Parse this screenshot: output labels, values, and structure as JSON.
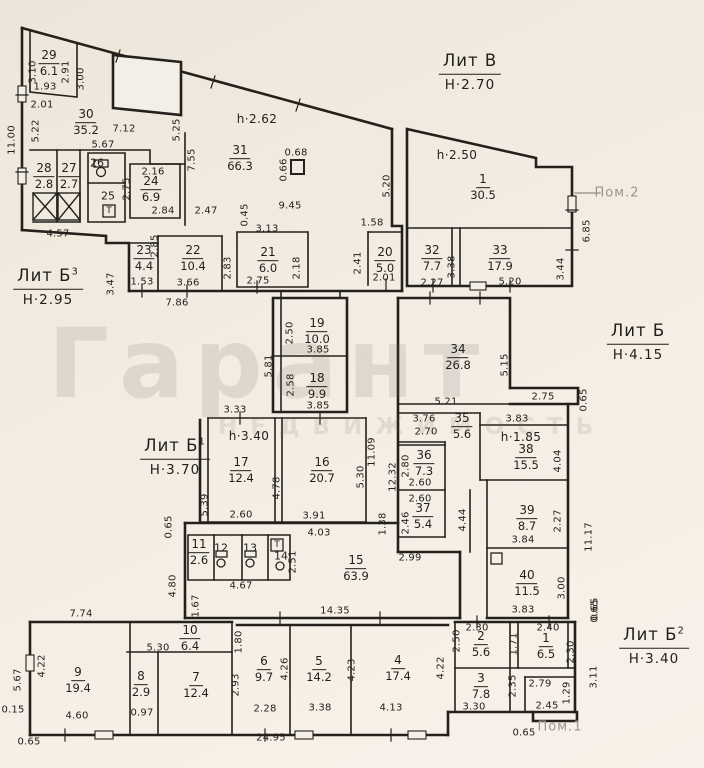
{
  "watermark": {
    "line1": "Гарант",
    "line2": "НЕДВИЖИМОСТЬ"
  },
  "colors": {
    "ink": "#211f1b",
    "paper": "#f2ede3",
    "watermark_grey": "#9a948a"
  },
  "buildings": [
    {
      "label": "Лит В",
      "sup": "",
      "height": "Н·2.70",
      "x": 470,
      "y": 72
    },
    {
      "label": "Лит Б",
      "sup": "3",
      "height": "Н·2.95",
      "x": 48,
      "y": 287
    },
    {
      "label": "Лит Б",
      "sup": "",
      "height": "Н·4.15",
      "x": 638,
      "y": 342
    },
    {
      "label": "Лит Б",
      "sup": "1",
      "height": "Н·3.70",
      "x": 175,
      "y": 457
    },
    {
      "label": "Лит Б",
      "sup": "2",
      "height": "Н·3.40",
      "x": 654,
      "y": 646
    }
  ],
  "rooms": [
    {
      "n": "29",
      "a": "6.1",
      "x": 49,
      "y": 63
    },
    {
      "n": "30",
      "a": "35.2",
      "x": 86,
      "y": 122
    },
    {
      "n": "31",
      "a": "66.3",
      "x": 240,
      "y": 158
    },
    {
      "n": "1",
      "a": "30.5",
      "x": 483,
      "y": 187
    },
    {
      "n": "28",
      "a": "2.8",
      "x": 44,
      "y": 176
    },
    {
      "n": "27",
      "a": "2.7",
      "x": 69,
      "y": 176
    },
    {
      "n": "26",
      "a": null,
      "x": 97,
      "y": 163
    },
    {
      "n": "25",
      "a": null,
      "x": 108,
      "y": 196
    },
    {
      "n": "24",
      "a": "6.9",
      "x": 151,
      "y": 189
    },
    {
      "n": "23",
      "a": "4.4",
      "x": 144,
      "y": 258
    },
    {
      "n": "22",
      "a": "10.4",
      "x": 193,
      "y": 258
    },
    {
      "n": "21",
      "a": "6.0",
      "x": 268,
      "y": 260
    },
    {
      "n": "20",
      "a": "5.0",
      "x": 385,
      "y": 260
    },
    {
      "n": "32",
      "a": "7.7",
      "x": 432,
      "y": 258
    },
    {
      "n": "33",
      "a": "17.9",
      "x": 500,
      "y": 258
    },
    {
      "n": "19",
      "a": "10.0",
      "x": 317,
      "y": 331
    },
    {
      "n": "18",
      "a": "9.9",
      "x": 317,
      "y": 386
    },
    {
      "n": "34",
      "a": "26.8",
      "x": 458,
      "y": 357
    },
    {
      "n": "17",
      "a": "12.4",
      "x": 241,
      "y": 470
    },
    {
      "n": "16",
      "a": "20.7",
      "x": 322,
      "y": 470
    },
    {
      "n": "35",
      "a": "5.6",
      "x": 462,
      "y": 426
    },
    {
      "n": "36",
      "a": "7.3",
      "x": 424,
      "y": 463
    },
    {
      "n": "37",
      "a": "5.4",
      "x": 423,
      "y": 516
    },
    {
      "n": "38",
      "a": "15.5",
      "x": 526,
      "y": 457
    },
    {
      "n": "39",
      "a": "8.7",
      "x": 527,
      "y": 518
    },
    {
      "n": "40",
      "a": "11.5",
      "x": 527,
      "y": 583
    },
    {
      "n": "15",
      "a": "63.9",
      "x": 356,
      "y": 568
    },
    {
      "n": "11",
      "a": "2.6",
      "x": 199,
      "y": 552
    },
    {
      "n": "12",
      "a": null,
      "x": 221,
      "y": 548
    },
    {
      "n": "13",
      "a": null,
      "x": 250,
      "y": 548
    },
    {
      "n": "14",
      "a": null,
      "x": 281,
      "y": 556
    },
    {
      "n": "10",
      "a": "6.4",
      "x": 190,
      "y": 638
    },
    {
      "n": "9",
      "a": "19.4",
      "x": 78,
      "y": 680
    },
    {
      "n": "8",
      "a": "2.9",
      "x": 141,
      "y": 684
    },
    {
      "n": "7",
      "a": "12.4",
      "x": 196,
      "y": 685
    },
    {
      "n": "6",
      "a": "9.7",
      "x": 264,
      "y": 669
    },
    {
      "n": "5",
      "a": "14.2",
      "x": 319,
      "y": 669
    },
    {
      "n": "4",
      "a": "17.4",
      "x": 398,
      "y": 668
    },
    {
      "n": "3",
      "a": "7.8",
      "x": 481,
      "y": 686
    },
    {
      "n": "2",
      "a": "5.6",
      "x": 481,
      "y": 644
    },
    {
      "n": "1",
      "a": "6.5",
      "x": 546,
      "y": 646
    }
  ],
  "heights": [
    {
      "t": "h·2.62",
      "x": 257,
      "y": 119
    },
    {
      "t": "h·2.50",
      "x": 457,
      "y": 155
    },
    {
      "t": "h·3.40",
      "x": 249,
      "y": 436
    },
    {
      "t": "h·1.85",
      "x": 521,
      "y": 437
    }
  ],
  "notes": [
    {
      "t": "Пом.2",
      "x": 617,
      "y": 193
    },
    {
      "t": "Пом.1",
      "x": 560,
      "y": 727
    }
  ],
  "icons": [
    {
      "t": "Т",
      "x": 109,
      "y": 211
    },
    {
      "t": "Т",
      "x": 277,
      "y": 545
    }
  ],
  "dims": [
    {
      "t": "11.00",
      "x": 12,
      "y": 140,
      "v": 1
    },
    {
      "t": "3.10",
      "x": 33,
      "y": 72,
      "v": 1
    },
    {
      "t": "2.91",
      "x": 66,
      "y": 72,
      "v": 1
    },
    {
      "t": "3.00",
      "x": 81,
      "y": 79,
      "v": 1
    },
    {
      "t": "1.93",
      "x": 45,
      "y": 87
    },
    {
      "t": "2.01",
      "x": 42,
      "y": 105
    },
    {
      "t": "5.22",
      "x": 36,
      "y": 131,
      "v": 1
    },
    {
      "t": "7.12",
      "x": 124,
      "y": 129
    },
    {
      "t": "5.25",
      "x": 177,
      "y": 130,
      "v": 1
    },
    {
      "t": "5.67",
      "x": 103,
      "y": 145
    },
    {
      "t": "7.55",
      "x": 192,
      "y": 160,
      "v": 1
    },
    {
      "t": "2.16",
      "x": 153,
      "y": 172
    },
    {
      "t": "2.75",
      "x": 127,
      "y": 189,
      "v": 1
    },
    {
      "t": "2.84",
      "x": 163,
      "y": 211
    },
    {
      "t": "2.47",
      "x": 206,
      "y": 211
    },
    {
      "t": "4.57",
      "x": 58,
      "y": 234
    },
    {
      "t": "0.45",
      "x": 245,
      "y": 215,
      "v": 1
    },
    {
      "t": "3.13",
      "x": 267,
      "y": 229
    },
    {
      "t": "9.45",
      "x": 290,
      "y": 206
    },
    {
      "t": "0.68",
      "x": 296,
      "y": 153
    },
    {
      "t": "0.66",
      "x": 284,
      "y": 170,
      "v": 1
    },
    {
      "t": "5.20",
      "x": 387,
      "y": 186,
      "v": 1
    },
    {
      "t": "1.58",
      "x": 372,
      "y": 223
    },
    {
      "t": "2.41",
      "x": 358,
      "y": 263,
      "v": 1
    },
    {
      "t": "2.01",
      "x": 384,
      "y": 278
    },
    {
      "t": "2.85",
      "x": 155,
      "y": 246,
      "v": 1
    },
    {
      "t": "1.53",
      "x": 142,
      "y": 282
    },
    {
      "t": "3.66",
      "x": 188,
      "y": 283
    },
    {
      "t": "2.83",
      "x": 228,
      "y": 268,
      "v": 1
    },
    {
      "t": "3.47",
      "x": 111,
      "y": 284,
      "v": 1
    },
    {
      "t": "7.86",
      "x": 177,
      "y": 303
    },
    {
      "t": "2.75",
      "x": 258,
      "y": 281
    },
    {
      "t": "2.18",
      "x": 297,
      "y": 268,
      "v": 1
    },
    {
      "t": "2.27",
      "x": 432,
      "y": 283
    },
    {
      "t": "3.38",
      "x": 452,
      "y": 267,
      "v": 1
    },
    {
      "t": "5.20",
      "x": 510,
      "y": 282
    },
    {
      "t": "3.44",
      "x": 561,
      "y": 269,
      "v": 1
    },
    {
      "t": "6.85",
      "x": 587,
      "y": 231,
      "v": 1
    },
    {
      "t": "2.50",
      "x": 290,
      "y": 333,
      "v": 1
    },
    {
      "t": "3.85",
      "x": 318,
      "y": 350
    },
    {
      "t": "2.58",
      "x": 291,
      "y": 385,
      "v": 1
    },
    {
      "t": "3.85",
      "x": 318,
      "y": 406
    },
    {
      "t": "5.81",
      "x": 269,
      "y": 366,
      "v": 1
    },
    {
      "t": "5.21",
      "x": 446,
      "y": 402
    },
    {
      "t": "5.15",
      "x": 505,
      "y": 365,
      "v": 1
    },
    {
      "t": "2.75",
      "x": 543,
      "y": 397
    },
    {
      "t": "0.65",
      "x": 584,
      "y": 400,
      "v": 1
    },
    {
      "t": "3.83",
      "x": 517,
      "y": 419
    },
    {
      "t": "3.33",
      "x": 235,
      "y": 410
    },
    {
      "t": "11.09",
      "x": 372,
      "y": 452,
      "v": 1
    },
    {
      "t": "12.32",
      "x": 393,
      "y": 477,
      "v": 1
    },
    {
      "t": "2.60",
      "x": 241,
      "y": 515
    },
    {
      "t": "5.39",
      "x": 205,
      "y": 505,
      "v": 1
    },
    {
      "t": "4.78",
      "x": 277,
      "y": 488,
      "v": 1
    },
    {
      "t": "5.30",
      "x": 361,
      "y": 477,
      "v": 1
    },
    {
      "t": "3.91",
      "x": 314,
      "y": 516
    },
    {
      "t": "4.03",
      "x": 319,
      "y": 533
    },
    {
      "t": "1.38",
      "x": 383,
      "y": 524,
      "v": 1
    },
    {
      "t": "0.65",
      "x": 169,
      "y": 527,
      "v": 1
    },
    {
      "t": "3.76",
      "x": 424,
      "y": 419
    },
    {
      "t": "2.70",
      "x": 426,
      "y": 432
    },
    {
      "t": "2.80",
      "x": 406,
      "y": 466,
      "v": 1
    },
    {
      "t": "2.60",
      "x": 420,
      "y": 483
    },
    {
      "t": "2.60",
      "x": 420,
      "y": 499
    },
    {
      "t": "2.46",
      "x": 406,
      "y": 523,
      "v": 1
    },
    {
      "t": "4.44",
      "x": 463,
      "y": 520,
      "v": 1
    },
    {
      "t": "2.99",
      "x": 410,
      "y": 558
    },
    {
      "t": "4.04",
      "x": 558,
      "y": 461,
      "v": 1
    },
    {
      "t": "2.27",
      "x": 558,
      "y": 521,
      "v": 1
    },
    {
      "t": "3.84",
      "x": 523,
      "y": 540
    },
    {
      "t": "3.00",
      "x": 562,
      "y": 588,
      "v": 1
    },
    {
      "t": "3.83",
      "x": 523,
      "y": 610
    },
    {
      "t": "11.17",
      "x": 589,
      "y": 537,
      "v": 1
    },
    {
      "t": "0.65",
      "x": 595,
      "y": 609,
      "v": 1
    },
    {
      "t": "2.51",
      "x": 293,
      "y": 562,
      "v": 1
    },
    {
      "t": "4.67",
      "x": 241,
      "y": 586
    },
    {
      "t": "14.35",
      "x": 335,
      "y": 611
    },
    {
      "t": "4.80",
      "x": 173,
      "y": 586,
      "v": 1
    },
    {
      "t": "1.67",
      "x": 196,
      "y": 606,
      "v": 1
    },
    {
      "t": "7.74",
      "x": 81,
      "y": 614
    },
    {
      "t": "5.67",
      "x": 18,
      "y": 680,
      "v": 1
    },
    {
      "t": "4.22",
      "x": 42,
      "y": 666,
      "v": 1
    },
    {
      "t": "4.60",
      "x": 77,
      "y": 716
    },
    {
      "t": "0.15",
      "x": 13,
      "y": 710
    },
    {
      "t": "0.65",
      "x": 29,
      "y": 742
    },
    {
      "t": "0.97",
      "x": 142,
      "y": 713
    },
    {
      "t": "5.30",
      "x": 158,
      "y": 648
    },
    {
      "t": "1.80",
      "x": 239,
      "y": 642,
      "v": 1
    },
    {
      "t": "2.93",
      "x": 236,
      "y": 685,
      "v": 1
    },
    {
      "t": "4.26",
      "x": 285,
      "y": 669,
      "v": 1
    },
    {
      "t": "2.28",
      "x": 265,
      "y": 709
    },
    {
      "t": "3.38",
      "x": 320,
      "y": 708
    },
    {
      "t": "4.23",
      "x": 352,
      "y": 670,
      "v": 1
    },
    {
      "t": "4.13",
      "x": 391,
      "y": 708
    },
    {
      "t": "4.22",
      "x": 441,
      "y": 668,
      "v": 1
    },
    {
      "t": "24.95",
      "x": 271,
      "y": 738
    },
    {
      "t": "2.30",
      "x": 477,
      "y": 628
    },
    {
      "t": "2.50",
      "x": 457,
      "y": 641,
      "v": 1
    },
    {
      "t": "2.40",
      "x": 548,
      "y": 628
    },
    {
      "t": "1.71",
      "x": 514,
      "y": 644,
      "v": 1
    },
    {
      "t": "2.30",
      "x": 571,
      "y": 652,
      "v": 1
    },
    {
      "t": "2.35",
      "x": 513,
      "y": 686,
      "v": 1
    },
    {
      "t": "3.30",
      "x": 474,
      "y": 707
    },
    {
      "t": "2.79",
      "x": 540,
      "y": 684
    },
    {
      "t": "2.45",
      "x": 547,
      "y": 706
    },
    {
      "t": "1.29",
      "x": 567,
      "y": 693,
      "v": 1
    },
    {
      "t": "3.11",
      "x": 594,
      "y": 677,
      "v": 1
    },
    {
      "t": "0.65",
      "x": 524,
      "y": 733
    },
    {
      "t": "0.65",
      "x": 595,
      "y": 611,
      "v": 1
    }
  ]
}
